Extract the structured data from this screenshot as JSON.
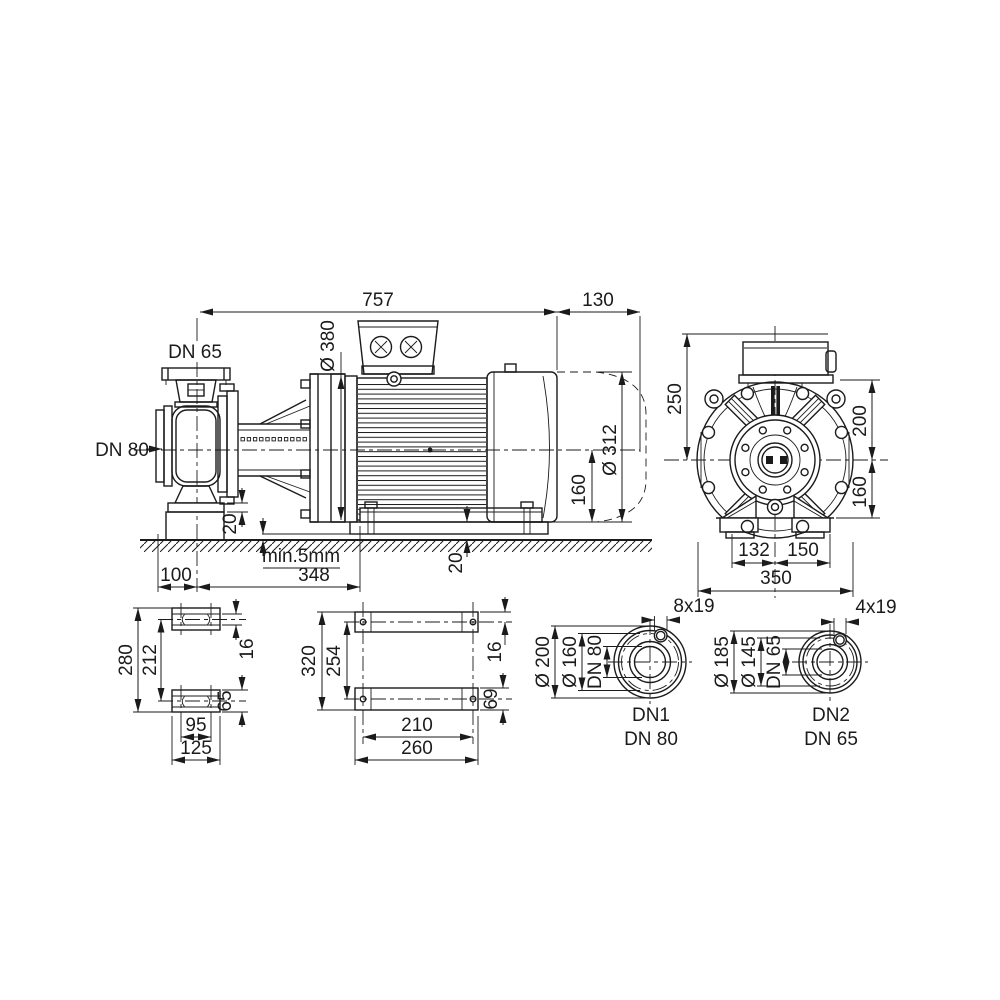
{
  "colors": {
    "line": "#1b1b1b",
    "background": "#ffffff"
  },
  "side": {
    "overall_length": "757",
    "fan_clearance": "130",
    "discharge_flange": "DN 65",
    "suction_flange": "DN 80",
    "adapter_flange_dia": "Ø 380",
    "motor_dia": "Ø 312",
    "shaft_height": "160",
    "pump_foot_thickness": "20",
    "motor_shim_height": "20",
    "grout_note": "min.5mm",
    "suction_offset": "100",
    "support_distance": "348"
  },
  "front": {
    "box_top_to_center": "250",
    "flange_top_to_center": "200",
    "center_to_base": "160",
    "foot_left": "132",
    "foot_right": "150",
    "overall_width": "350"
  },
  "pump_foot": {
    "overall_length": "280",
    "hole_pitch": "212",
    "slot_width": "16",
    "foot_width": "65",
    "hole_pitch_cross": "95",
    "overall_width": "125"
  },
  "motor_foot": {
    "overall_length": "320",
    "hole_pitch": "254",
    "edge_offset": "16",
    "foot_width": "69",
    "hole_pitch_cross": "210",
    "overall_width": "260"
  },
  "flange1": {
    "outer_dia": "Ø 200",
    "bolt_circle": "Ø 160",
    "bore": "DN 80",
    "holes": "8x19",
    "port_id": "DN1",
    "port_size": "DN 80"
  },
  "flange2": {
    "outer_dia": "Ø 185",
    "bolt_circle": "Ø 145",
    "bore": "DN 65",
    "holes": "4x19",
    "port_id": "DN2",
    "port_size": "DN 65"
  }
}
